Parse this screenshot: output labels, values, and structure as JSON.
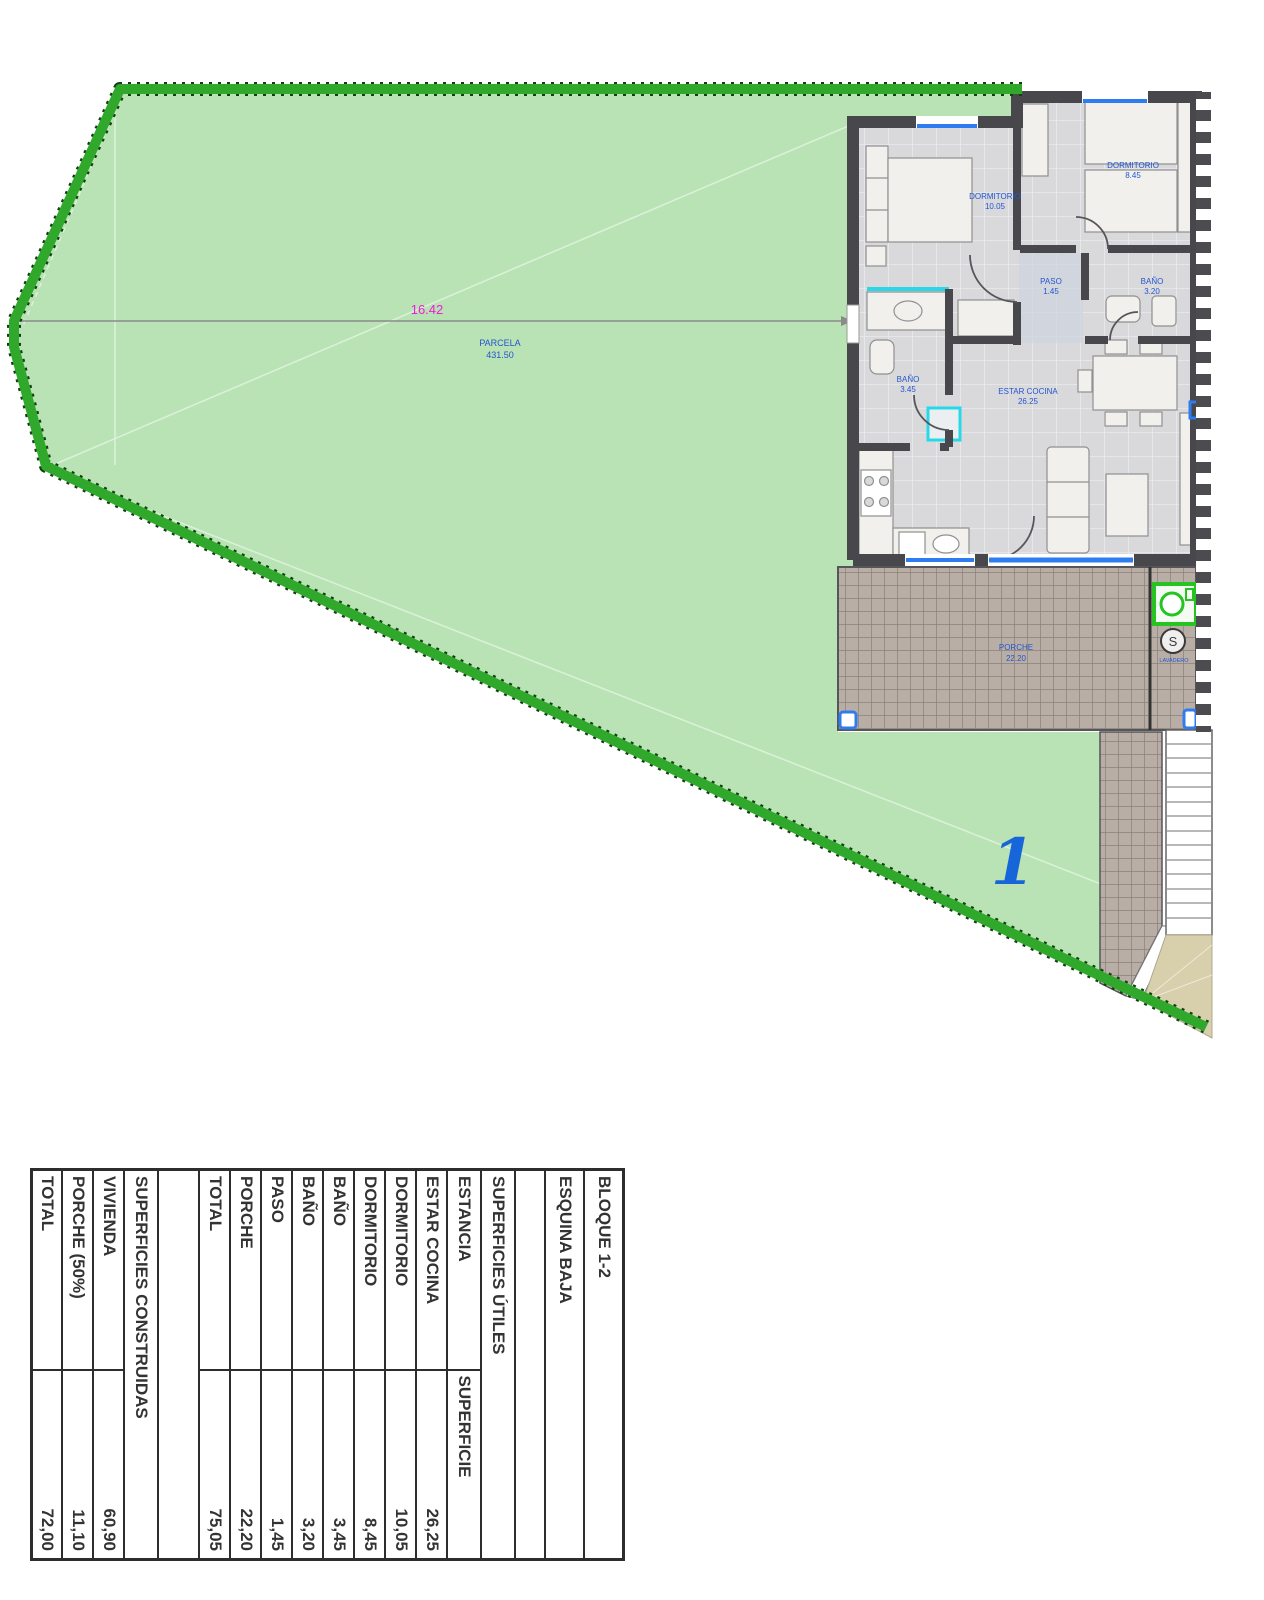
{
  "plan": {
    "dimension": "16.42",
    "parcel": {
      "name": "PARCELA",
      "area": "431.50"
    },
    "plot_number": "1",
    "meter_symbol": "S",
    "labels": {
      "bedroom1": {
        "name": "DORMITORIO",
        "area": "10.05"
      },
      "bedroom2": {
        "name": "DORMITORIO",
        "area": "8.45"
      },
      "paso": {
        "name": "PASO",
        "area": "1.45"
      },
      "bath1": {
        "name": "BAÑO",
        "area": "3.45"
      },
      "bath2": {
        "name": "BAÑO",
        "area": "3.20"
      },
      "living": {
        "name": "ESTAR COCINA",
        "area": "26.25"
      },
      "porch": {
        "name": "PORCHE",
        "area": "22.20"
      },
      "laundry": {
        "name": "LAVADERO",
        "area": ""
      }
    },
    "colors": {
      "lawn": "#b9e3b5",
      "border_green": "#2fa82c",
      "label_blue": "#2456cf",
      "dimension_magenta": "#ee1ed6",
      "plot_blue": "#1666d9",
      "tile": "#b8aea6"
    }
  },
  "table": {
    "titles": [
      "BLOQUE 1-2",
      "ESQUINA BAJA"
    ],
    "utiles": {
      "section": "SUPERFICIES ÚTILES",
      "headers": [
        "ESTANCIA",
        "SUPERFICIE"
      ],
      "rows": [
        [
          "ESTAR COCINA",
          "26,25"
        ],
        [
          "DORMITORIO",
          "10,05"
        ],
        [
          "DORMITORIO",
          "8,45"
        ],
        [
          "BAÑO",
          "3,45"
        ],
        [
          "BAÑO",
          "3,20"
        ],
        [
          "PASO",
          "1,45"
        ],
        [
          "PORCHE",
          "22,20"
        ],
        [
          "TOTAL",
          "75,05"
        ]
      ]
    },
    "construidas": {
      "section": "SUPERFICIES CONSTRUIDAS",
      "rows": [
        [
          "VIVIENDA",
          "60,90"
        ],
        [
          "PORCHE (50%)",
          "11,10"
        ],
        [
          "TOTAL",
          "72,00"
        ]
      ]
    }
  }
}
